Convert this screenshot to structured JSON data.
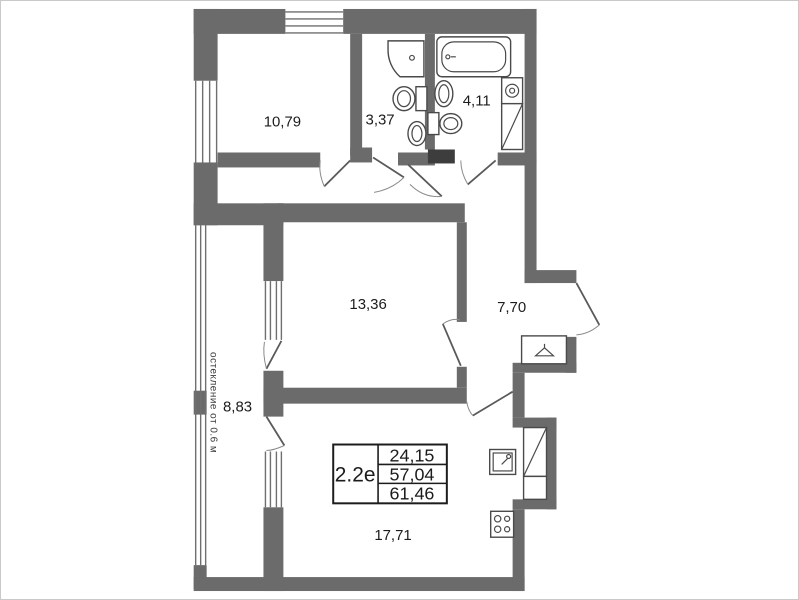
{
  "plan": {
    "rooms": {
      "bedroom": {
        "area": "10,79"
      },
      "shower_room": {
        "area": "3,37"
      },
      "bathroom": {
        "area": "4,11"
      },
      "living_room": {
        "area": "13,36"
      },
      "hallway": {
        "area": "7,70"
      },
      "balcony": {
        "area": "8,83"
      },
      "kitchen_living": {
        "area": "17,71"
      }
    },
    "info_box": {
      "plan_type": "2.2е",
      "rows": [
        "24,15",
        "57,04",
        "61,46"
      ]
    },
    "glazing_note": "остекление от 0.6 м",
    "colors": {
      "wall": "#6b6b6b",
      "accent_block": "#3d3d3d",
      "fixture_line": "#4a4a4a"
    }
  }
}
